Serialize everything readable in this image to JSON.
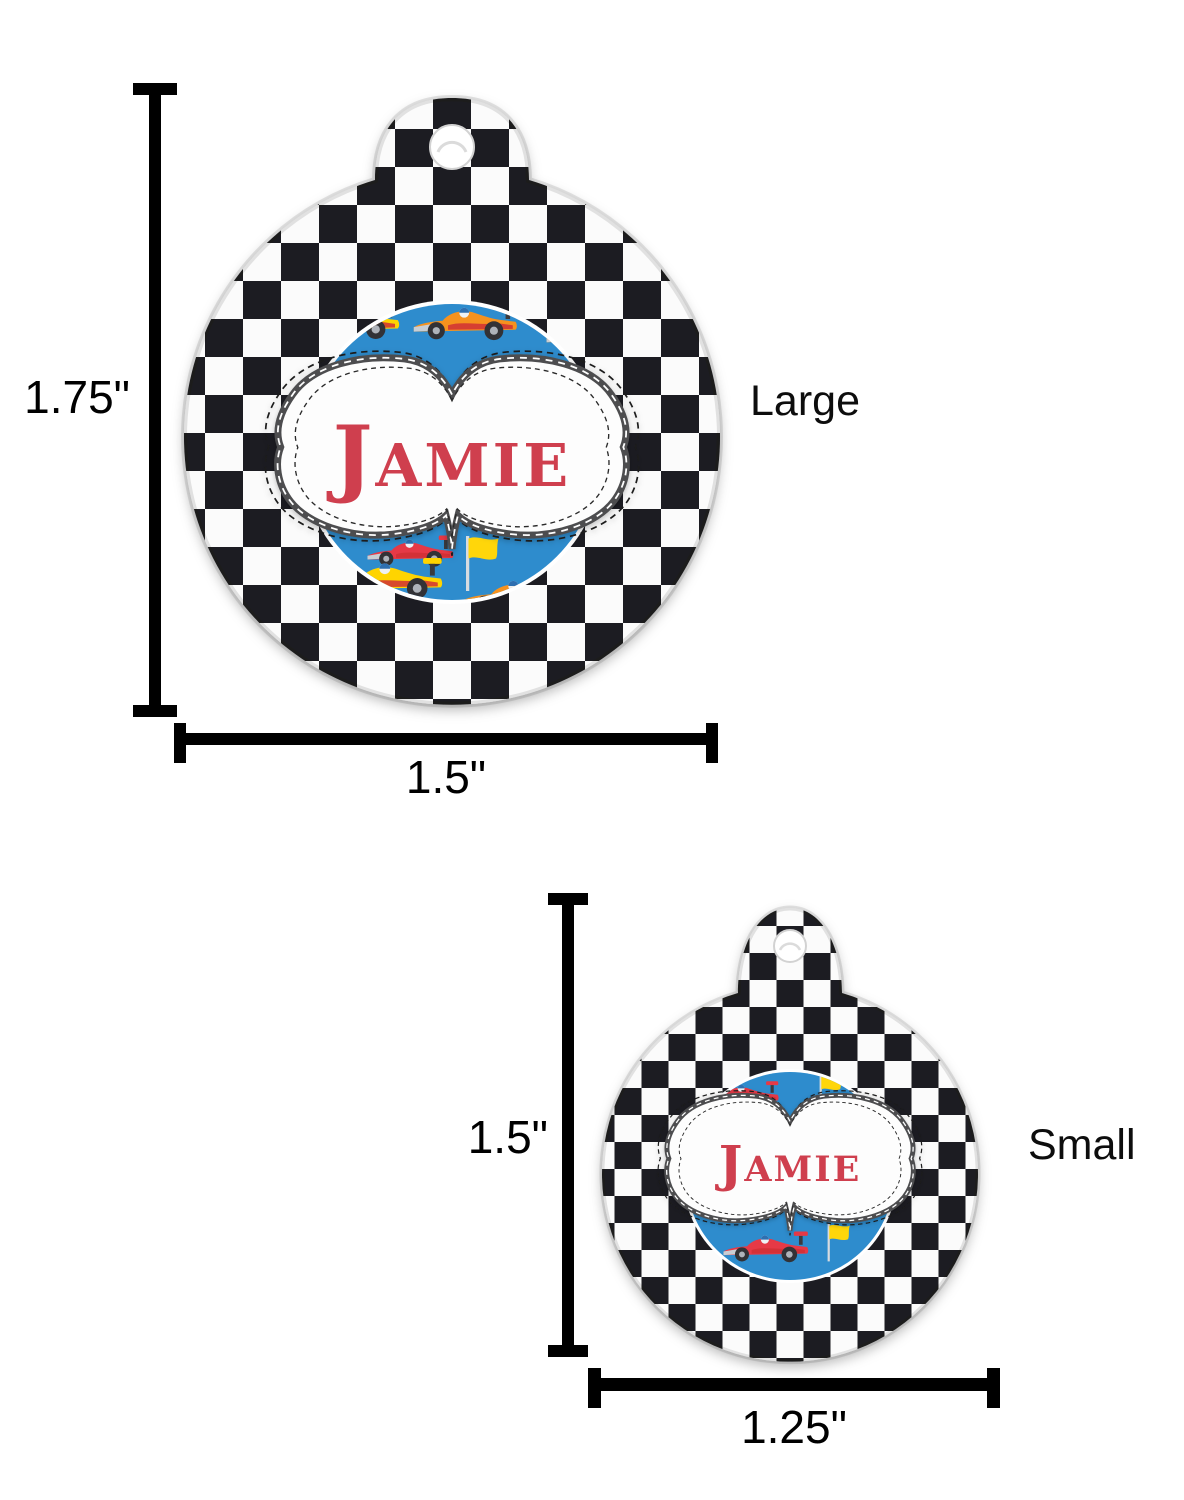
{
  "labels": {
    "large": {
      "size": "Large",
      "name": "Jamie",
      "height": "1.75\"",
      "width": "1.5\""
    },
    "small": {
      "size": "Small",
      "name": "Jamie",
      "height": "1.5\"",
      "width": "1.25\""
    }
  },
  "artwork": {
    "pattern": "black-white-checkerboard",
    "icons": [
      "race-car-icon",
      "racing-flag-icon",
      "tag-hole-icon",
      "stitched-label-frame"
    ],
    "colors": {
      "checker_dark": "#1d1d20",
      "checker_light": "#fbfbfb",
      "center_blue": "#2e8ccd",
      "name_red": "#cf3f4e",
      "frame_gray": "#4d4e50",
      "dimension_line": "#000000",
      "car_orange": "#f6921e",
      "car_yellow": "#ffd400",
      "car_red": "#e63946",
      "flag_yellow": "#ffd60a"
    }
  }
}
